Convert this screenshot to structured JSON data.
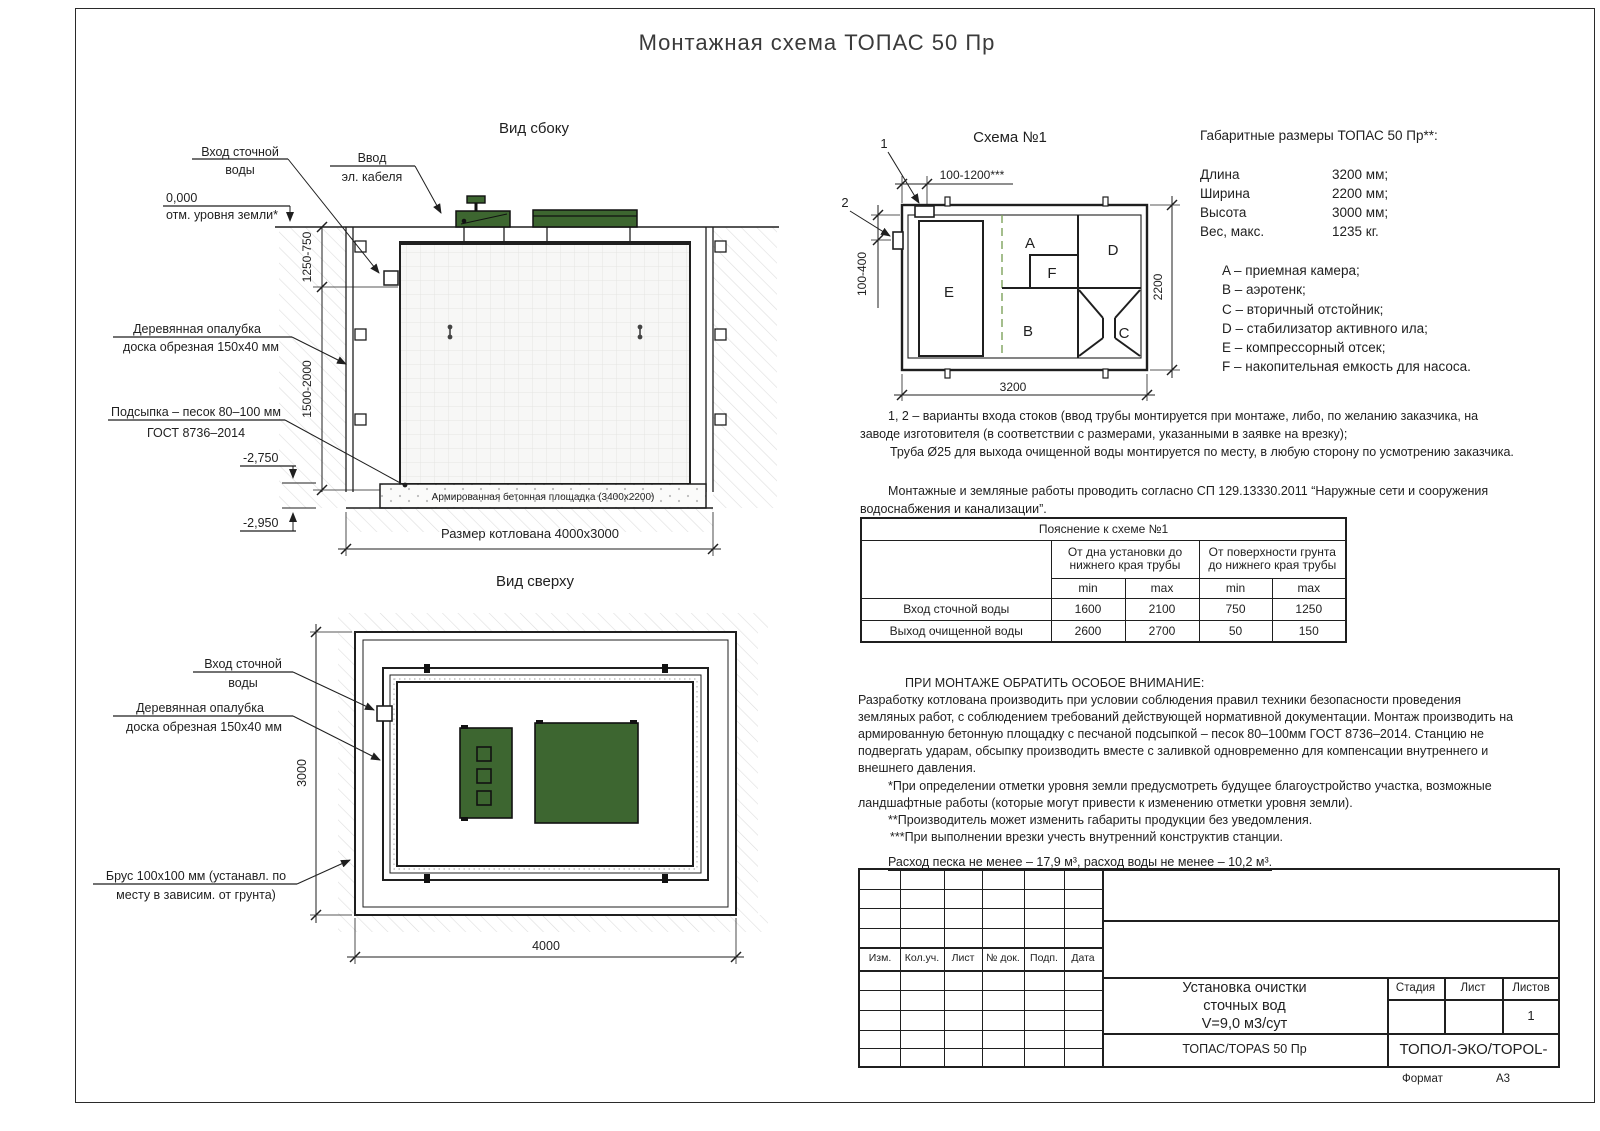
{
  "page": {
    "title": "Монтажная схема ТОПАС 50 Пр",
    "format_label": "Формат",
    "format_value": "А3"
  },
  "colors": {
    "line": "#1f1f1f",
    "green": "#3d6630",
    "hatch": "#dedede"
  },
  "side_view": {
    "title": "Вид сбоку",
    "inlet_l1": "Вход сточной",
    "inlet_l2": "воды",
    "cable_l1": "Ввод",
    "cable_l2": "эл. кабеля",
    "zero": "0,000",
    "zero_sub": "отм. уровня земли*",
    "formwork_l1": "Деревянная опалубка",
    "formwork_l2": "доска обрезная 150х40 мм",
    "bedding_l1": "Подсыпка – песок 80–100 мм",
    "bedding_l2": "ГОСТ 8736–2014",
    "level_a": "-2,750",
    "level_b": "-2,950",
    "dim_a": "1250-750",
    "dim_b": "1500-2000",
    "slab": "Армированная бетонная площадка (3400х2200)",
    "pit": "Размер котлована 4000х3000"
  },
  "top_view": {
    "title": "Вид сверху",
    "inlet_l1": "Вход сточной",
    "inlet_l2": "воды",
    "formwork_l1": "Деревянная опалубка",
    "formwork_l2": "доска обрезная 150х40 мм",
    "beam_l1": "Брус 100х100 мм (устанавл. по",
    "beam_l2": "месту в зависим. от грунта)",
    "dim_w": "4000",
    "dim_h": "3000"
  },
  "schema": {
    "title": "Схема №1",
    "m1": "1",
    "m2": "2",
    "dim_top": "100-1200***",
    "dim_left": "100-400",
    "dim_right": "2200",
    "dim_bottom": "3200",
    "rooms": {
      "a": "A",
      "b": "B",
      "c": "C",
      "d": "D",
      "e": "E",
      "f": "F"
    }
  },
  "gabarits": {
    "title": "Габаритные размеры ТОПАС 50 Пр**:",
    "rows": [
      {
        "label": "Длина",
        "value": "3200 мм;"
      },
      {
        "label": "Ширина",
        "value": "2200 мм;"
      },
      {
        "label": "Высота",
        "value": "3000 мм;"
      },
      {
        "label": "Вес, макс.",
        "value": "1235 кг."
      }
    ]
  },
  "legend": [
    "A – приемная камера;",
    "B – аэротенк;",
    "C – вторичный отстойник;",
    "D – стабилизатор активного ила;",
    "E – компрессорный отсек;",
    "F – накопительная емкость для насоса."
  ],
  "notes": {
    "n1l1": "1, 2 – варианты входа  стоков (ввод трубы монтируется при монтаже, либо, по желанию заказчика, на",
    "n1l2": "заводе изготовителя (в соответствии с размерами, указанными в заявке на врезку);",
    "n1l3": "Труба Ø25 для выхода очищенной воды монтируется по месту, в любую сторону по усмотрению заказчика.",
    "n2l1": "Монтажные и земляные работы проводить согласно СП 129.13330.2011 “Наружные сети и сооружения",
    "n2l2": "водоснабжения и канализации”."
  },
  "table": {
    "title": "Пояснение к схеме №1",
    "group1": "От дна установки до\nнижнего края трубы",
    "group2": "От поверхности грунта\nдо нижнего края трубы",
    "min": "min",
    "max": "max",
    "rows": [
      {
        "label": "Вход сточной воды",
        "values": [
          "1600",
          "2100",
          "750",
          "1250"
        ]
      },
      {
        "label": "Выход очищенной воды",
        "values": [
          "2600",
          "2700",
          "50",
          "150"
        ]
      }
    ]
  },
  "attention": {
    "heading": "ПРИ МОНТАЖЕ ОБРАТИТЬ ОСОБОЕ ВНИМАНИЕ:",
    "b1": "Разработку котлована производить при условии соблюдения правил техники безопасности проведения",
    "b2": "земляных работ, с соблюдением требований действующей нормативной документации.  Монтаж производить на",
    "b3": "армированную бетонную площадку с песчаной подсыпкой – песок 80–100мм ГОСТ 8736–2014. Станцию не",
    "b4": "подвергать ударам, обсыпку производить вместе с заливкой одновременно для компенсации внутреннего и",
    "b5": "внешнего давления.",
    "f1": "*При определении отметки уровня земли предусмотреть будущее благоустройство участка, возможные",
    "f2": "ландшафтные работы (которые могут привести к изменению отметки уровня земли).",
    "f3": "**Производитель может изменить габариты продукции без уведомления.",
    "f4": "***При выполнении врезки учесть внутренний конструктив станции.",
    "consumption": "Расход песка не менее – 17,9 м³, расход воды не менее – 10,2 м³."
  },
  "stamp": {
    "col0": "Изм.",
    "col1": "Кол.уч.",
    "col2": "Лист",
    "col3": "№ док.",
    "col4": "Подп.",
    "col5": "Дата",
    "title_l1": "Установка очистки",
    "title_l2": "сточных вод",
    "title_l3": "V=9,0 м3/сут",
    "stage": "Стадия",
    "sheet": "Лист",
    "sheets": "Листов",
    "sheets_value": "1",
    "product": "ТОПАС/TOPAS 50 Пр",
    "company": "ТОПОЛ-ЭКО/TOPOL-ECO"
  }
}
